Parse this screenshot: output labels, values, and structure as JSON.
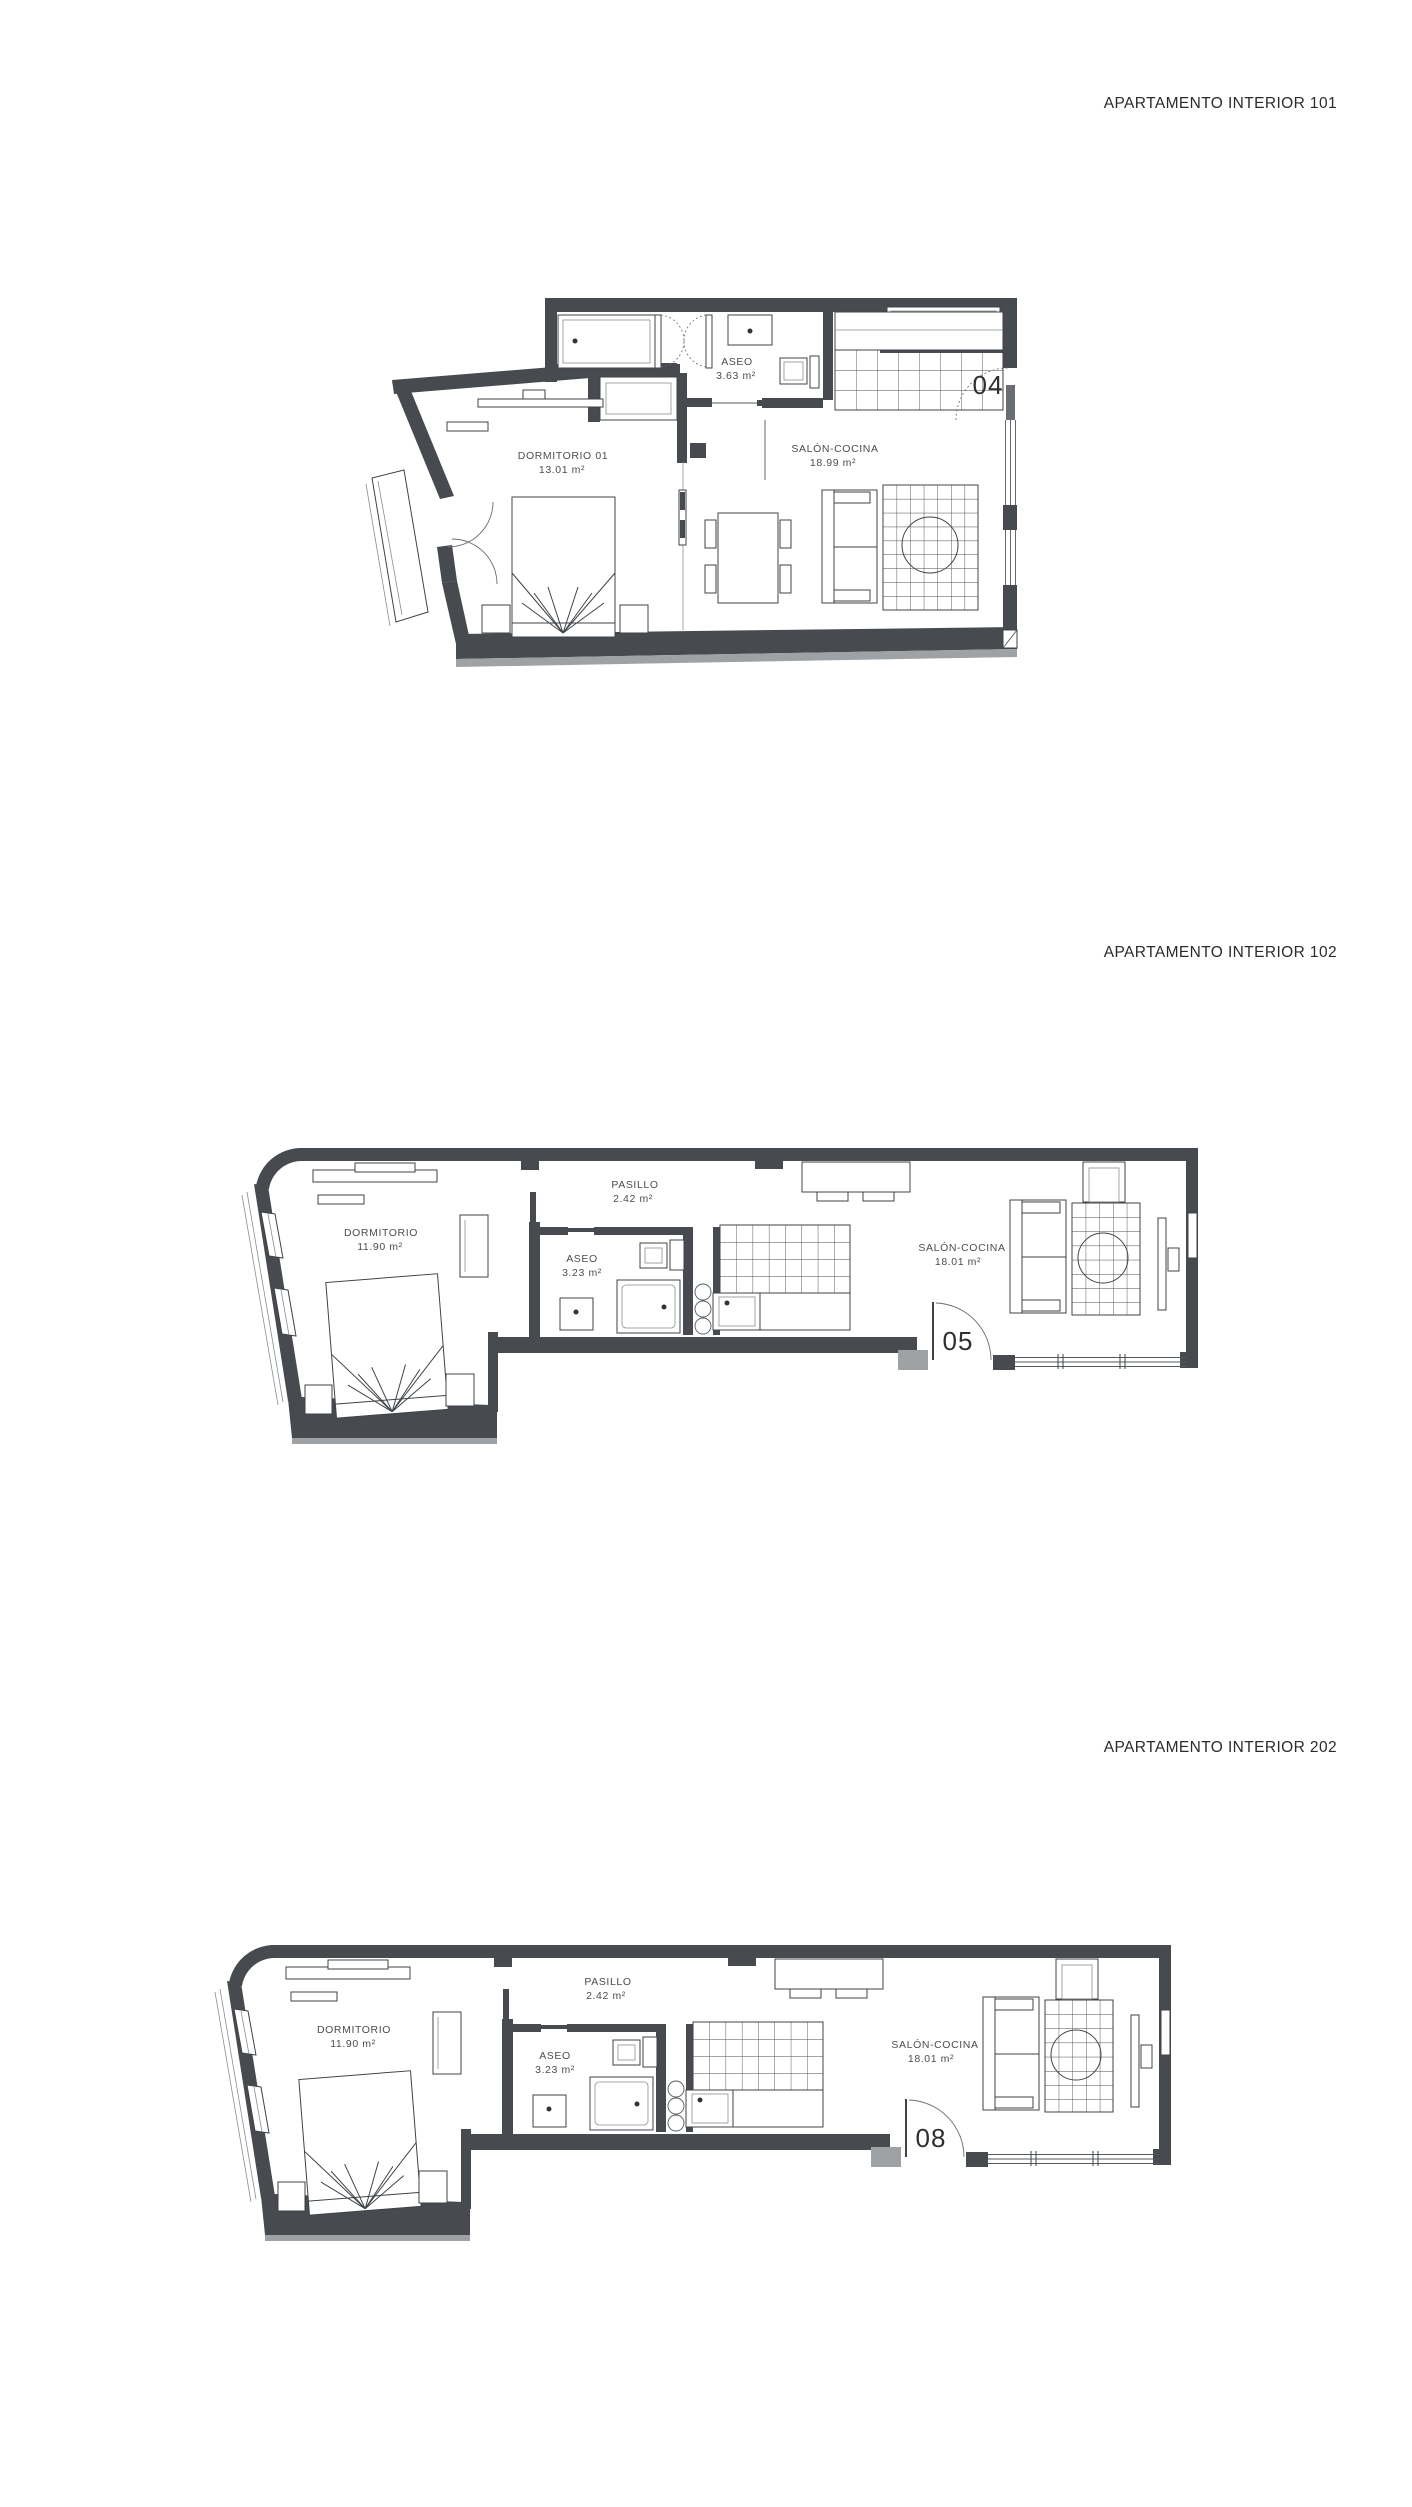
{
  "colors": {
    "background": "#ffffff",
    "wall": "#474b4f",
    "wall_light": "#9ea2a5",
    "line": "#3f4347",
    "label_text": "#4d4d4d",
    "title_text": "#2b2b2b"
  },
  "plans": [
    {
      "id": "101",
      "title": "APARTAMENTO INTERIOR 101",
      "door_number": "04",
      "rooms": [
        {
          "name": "DORMITORIO 01",
          "area": "13.01 m²"
        },
        {
          "name": "ASEO",
          "area": "3.63 m²"
        },
        {
          "name": "SALÓN-COCINA",
          "area": "18.99 m²"
        }
      ]
    },
    {
      "id": "102",
      "title": "APARTAMENTO INTERIOR 102",
      "door_number": "05",
      "rooms": [
        {
          "name": "DORMITORIO",
          "area": "11.90 m²"
        },
        {
          "name": "PASILLO",
          "area": "2.42 m²"
        },
        {
          "name": "ASEO",
          "area": "3.23 m²"
        },
        {
          "name": "SALÓN-COCINA",
          "area": "18.01 m²"
        }
      ]
    },
    {
      "id": "202",
      "title": "APARTAMENTO INTERIOR 202",
      "door_number": "08",
      "rooms": [
        {
          "name": "DORMITORIO",
          "area": "11.90 m²"
        },
        {
          "name": "PASILLO",
          "area": "2.42 m²"
        },
        {
          "name": "ASEO",
          "area": "3.23 m²"
        },
        {
          "name": "SALÓN-COCINA",
          "area": "18.01 m²"
        }
      ]
    }
  ]
}
